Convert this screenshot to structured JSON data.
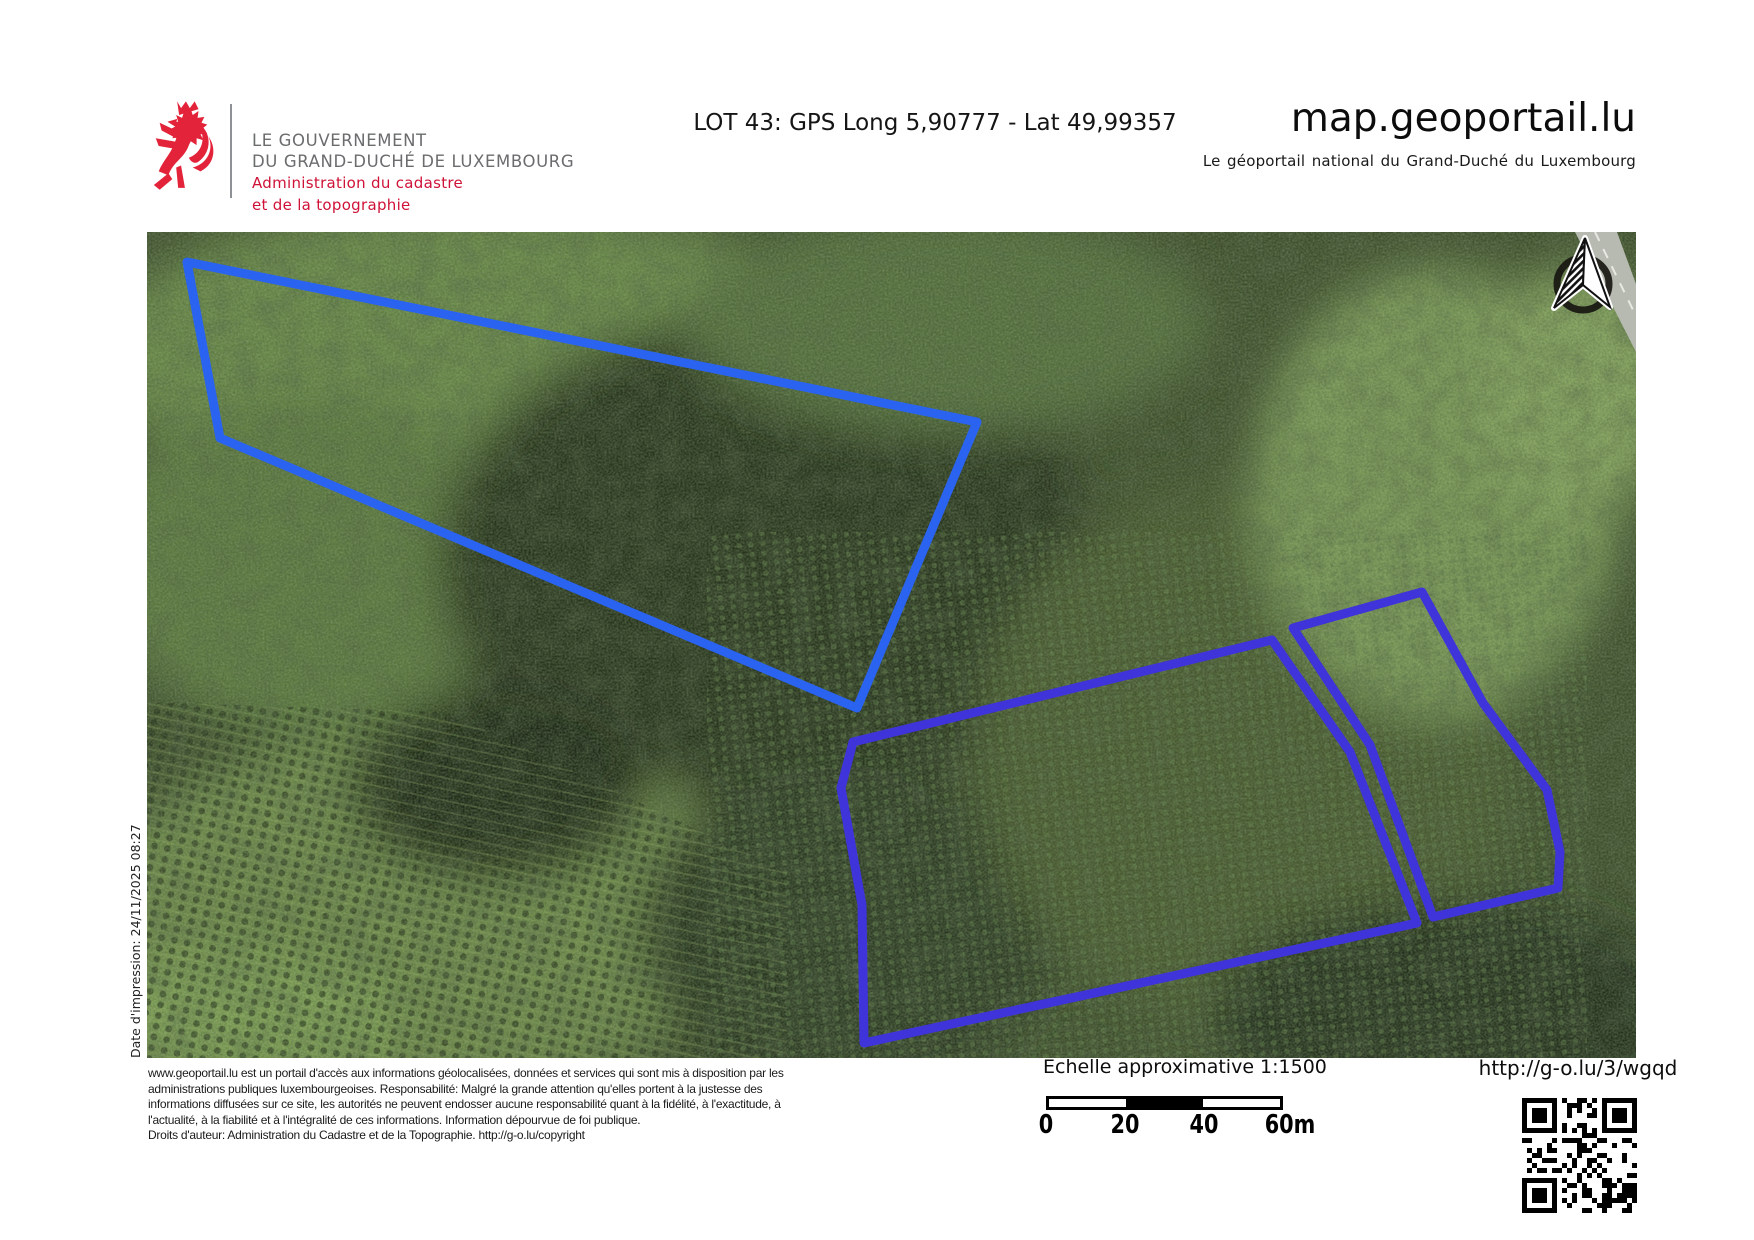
{
  "header": {
    "gov_logo": {
      "name_line1": "LE GOUVERNEMENT",
      "name_line2": "DU GRAND-DUCHÉ DE LUXEMBOURG",
      "dept_line1": "Administration du cadastre",
      "dept_line2": "et de la topographie",
      "lion_color": "#e32339"
    },
    "title": "LOT 43: GPS Long 5,90777 - Lat 49,99357",
    "brand": "map.geoportail.lu",
    "brand_subtitle": "Le géoportail national du Grand-Duché du Luxembourg"
  },
  "map": {
    "print_date_label": "Date d'impression: 24/11/2025 08:27",
    "stroke_width": 9,
    "parcels": [
      {
        "id": "parcel-outline-1",
        "color": "#2a63ef",
        "points": "40,30 830,190 710,476 73,206"
      },
      {
        "id": "parcel-outline-2",
        "color": "#3f33da",
        "points": "706,510 1125,408 1203,520 1270,691 717,811 715,673 694,556"
      },
      {
        "id": "parcel-outline-3",
        "color": "#3f33da",
        "points": "1146,396 1275,360 1336,471 1400,558 1413,620 1411,656 1286,685 1223,513"
      }
    ]
  },
  "footer": {
    "disclaimer_lines": [
      "www.geoportail.lu est un portail d'accès aux informations géolocalisées, données et services qui sont mis à disposition par les",
      "administrations publiques luxembourgeoises. Responsabilité: Malgré la grande attention qu'elles portent à la justesse des",
      "informations diffusées sur ce site, les autorités ne peuvent endosser aucune responsabilité quant à la fidélité, à l'exactitude, à",
      "l'actualité, à la fiabilité et à l'intégralité de ces informations. Information dépourvue de foi publique.",
      "Droits d'auteur: Administration du Cadastre et de la Topographie. http://g-o.lu/copyright"
    ],
    "scale_label": "Echelle approximative 1:1500",
    "scale_ticks": [
      "0",
      "20",
      "40",
      "60m"
    ],
    "share_url": "http://g-o.lu/3/wgqd"
  }
}
